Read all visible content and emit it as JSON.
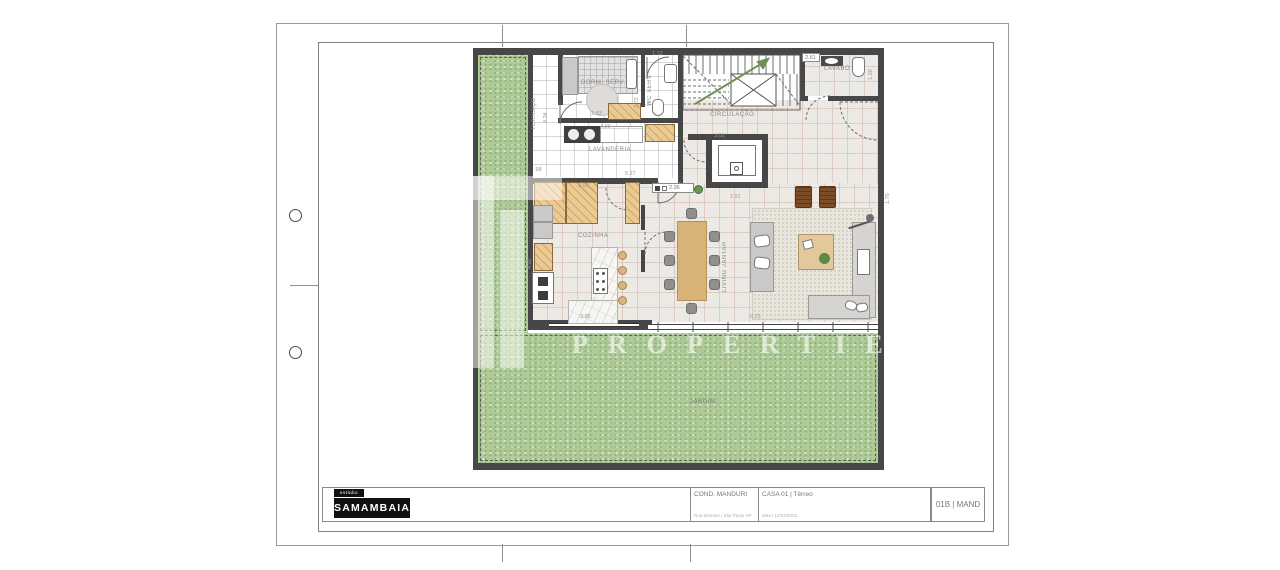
{
  "watermark": {
    "letters": "PROPERTIES"
  },
  "plan": {
    "rooms": {
      "terraco": "TERRAÇO",
      "dorm": "DORM. SERV.",
      "wc": "WC SERV.",
      "lavanderia": "LAVANDERIA",
      "circulacao": "CIRCULAÇÃO",
      "lavabo": "LAVABO",
      "cozinha": "COZINHA",
      "living": "LIVING JANTAR",
      "jardim": "JARDIM"
    },
    "dims": {
      "terraco_h": "4.34",
      "dorm_w": "2.83",
      "dorm_h": "2.72",
      "wc_w": "1.12",
      "lavanderia_w": "4.06",
      "lavanderia_left": ".98",
      "lavanderia_b": "5.27",
      "cozinha_top": "3.85",
      "circ_w": "3.03",
      "lavabo_w": "2.61",
      "lavabo_h": "1.20",
      "cozinha_h": "4.02",
      "door_tag": "2.36",
      "living_top": "2.91",
      "cozinha_b": "3.85",
      "living_b": "8.23",
      "living_r": "1.76"
    }
  },
  "title_block": {
    "studio_label": "estúdio",
    "studio_name": "SAMAMBAIA",
    "project_name": "COND. MANDURI",
    "project_sub": "Rua Manduri | São Paulo SP",
    "sheet_name": "CASA 01 | Térreo",
    "sheet_sub": "data | 12/04/2023",
    "sheet_code": "01B | MAND"
  }
}
